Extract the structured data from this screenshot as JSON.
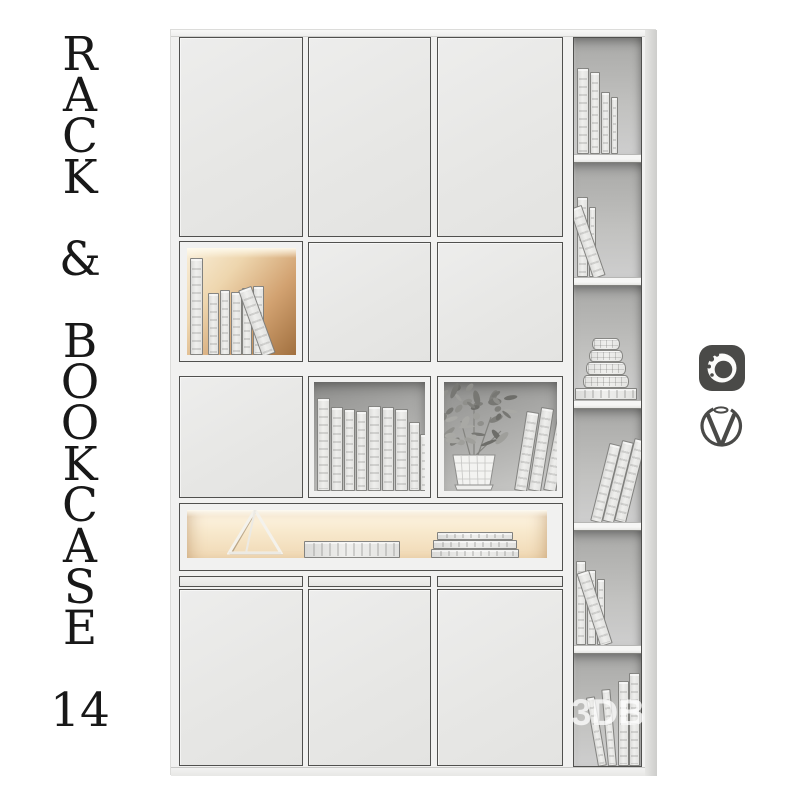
{
  "title": {
    "text": "R\nA\nC\nK\n\n&\n\nB\nO\nO\nK\nC\nA\nS\nE\n\n14"
  },
  "watermark": {
    "text": "3DB"
  },
  "logos": [
    {
      "name": "corona-renderer-logo",
      "shape": "rounded-square-with-swirl",
      "color": "#4a4a48"
    },
    {
      "name": "vray-logo",
      "shape": "circle-with-v",
      "color": "#4a4a48"
    }
  ],
  "colors": {
    "bg": "#ffffff",
    "frame": "#f1f1f0",
    "door": "#e9e9e8",
    "outline": "#50504e",
    "book": "#e9e9e7",
    "text": "#181818",
    "logo": "#4a4a48",
    "wm": "#ffffff",
    "warm_glow": "#a1703f",
    "soft_glow": "#f8e9cd",
    "cavity_gray": "#a8a8a6"
  },
  "scene": {
    "decor": [
      {
        "name": "wireframe-triangle"
      },
      {
        "name": "potted-plant"
      },
      {
        "name": "round-box-stack"
      }
    ],
    "book_groups": [
      {
        "group": "rc1",
        "items": [
          {
            "x": 3,
            "w": 12,
            "h": 86
          },
          {
            "x": 16,
            "w": 10,
            "h": 82
          },
          {
            "x": 27,
            "w": 9,
            "h": 62
          },
          {
            "x": 37,
            "w": 7,
            "h": 57
          }
        ]
      },
      {
        "group": "rc2",
        "items": [
          {
            "x": 3,
            "w": 11,
            "h": 80
          },
          {
            "x": 15,
            "w": 7,
            "h": 70
          },
          {
            "x": 19,
            "w": 13,
            "h": 74,
            "lean": -19
          }
        ]
      },
      {
        "group": "rc3",
        "items": [
          {
            "x": 1,
            "w": 62,
            "h": 12,
            "kind": "flat"
          },
          {
            "x": 9,
            "w": 46,
            "h": 13,
            "b": 12,
            "kind": "box"
          },
          {
            "x": 12,
            "w": 40,
            "h": 13,
            "b": 25,
            "kind": "box"
          },
          {
            "x": 15,
            "w": 34,
            "h": 12,
            "b": 38,
            "kind": "box"
          },
          {
            "x": 18,
            "w": 28,
            "h": 12,
            "b": 50,
            "kind": "box"
          }
        ]
      },
      {
        "group": "rc4",
        "items": [
          {
            "x": 16,
            "w": 12,
            "h": 80,
            "lean": 14
          },
          {
            "x": 28,
            "w": 12,
            "h": 83,
            "lean": 14
          },
          {
            "x": 40,
            "w": 12,
            "h": 85,
            "lean": 14
          }
        ]
      },
      {
        "group": "rc5",
        "items": [
          {
            "x": 2,
            "w": 10,
            "h": 84
          },
          {
            "x": 13,
            "w": 9,
            "h": 75
          },
          {
            "x": 23,
            "w": 8,
            "h": 66
          },
          {
            "x": 26,
            "w": 13,
            "h": 77,
            "lean": -18
          }
        ]
      },
      {
        "group": "rc6",
        "items": [
          {
            "x": 24,
            "w": 9,
            "h": 70,
            "lean": -10
          },
          {
            "x": 34,
            "w": 9,
            "h": 77,
            "lean": -5
          },
          {
            "x": 44,
            "w": 11,
            "h": 85
          },
          {
            "x": 55,
            "w": 11,
            "h": 93
          }
        ]
      },
      {
        "group": "r2books",
        "items": [
          {
            "x": 3,
            "w": 13,
            "h": 97
          },
          {
            "x": 21,
            "w": 11,
            "h": 62
          },
          {
            "x": 33,
            "w": 10,
            "h": 65
          },
          {
            "x": 44,
            "w": 11,
            "h": 63
          },
          {
            "x": 55,
            "w": 10,
            "h": 67
          },
          {
            "x": 66,
            "w": 11,
            "h": 69
          },
          {
            "x": 75,
            "w": 14,
            "h": 71,
            "lean": -20
          }
        ]
      },
      {
        "group": "r3mid",
        "items": [
          {
            "x": 3,
            "w": 13,
            "h": 93
          },
          {
            "x": 17,
            "w": 12,
            "h": 84
          },
          {
            "x": 30,
            "w": 11,
            "h": 82
          },
          {
            "x": 42,
            "w": 11,
            "h": 80
          },
          {
            "x": 54,
            "w": 13,
            "h": 85
          },
          {
            "x": 68,
            "w": 12,
            "h": 84
          },
          {
            "x": 81,
            "w": 13,
            "h": 82
          },
          {
            "x": 95,
            "w": 11,
            "h": 69
          },
          {
            "x": 106,
            "w": 9,
            "h": 57
          }
        ]
      },
      {
        "group": "r3right",
        "items": [
          {
            "x": 70,
            "w": 13,
            "h": 80,
            "lean": 9
          },
          {
            "x": 84,
            "w": 13,
            "h": 84,
            "lean": 9
          },
          {
            "x": 99,
            "w": 13,
            "h": 76,
            "lean": 11
          }
        ]
      },
      {
        "group": "r4items",
        "items": [
          {
            "x": 117,
            "w": 96,
            "h": 17,
            "kind": "flat"
          },
          {
            "x": 244,
            "w": 88,
            "h": 9,
            "kind": "flat"
          },
          {
            "x": 246,
            "w": 84,
            "h": 9,
            "b": 9,
            "kind": "flat"
          },
          {
            "x": 250,
            "w": 76,
            "h": 8,
            "b": 18,
            "kind": "flat"
          }
        ]
      }
    ]
  }
}
